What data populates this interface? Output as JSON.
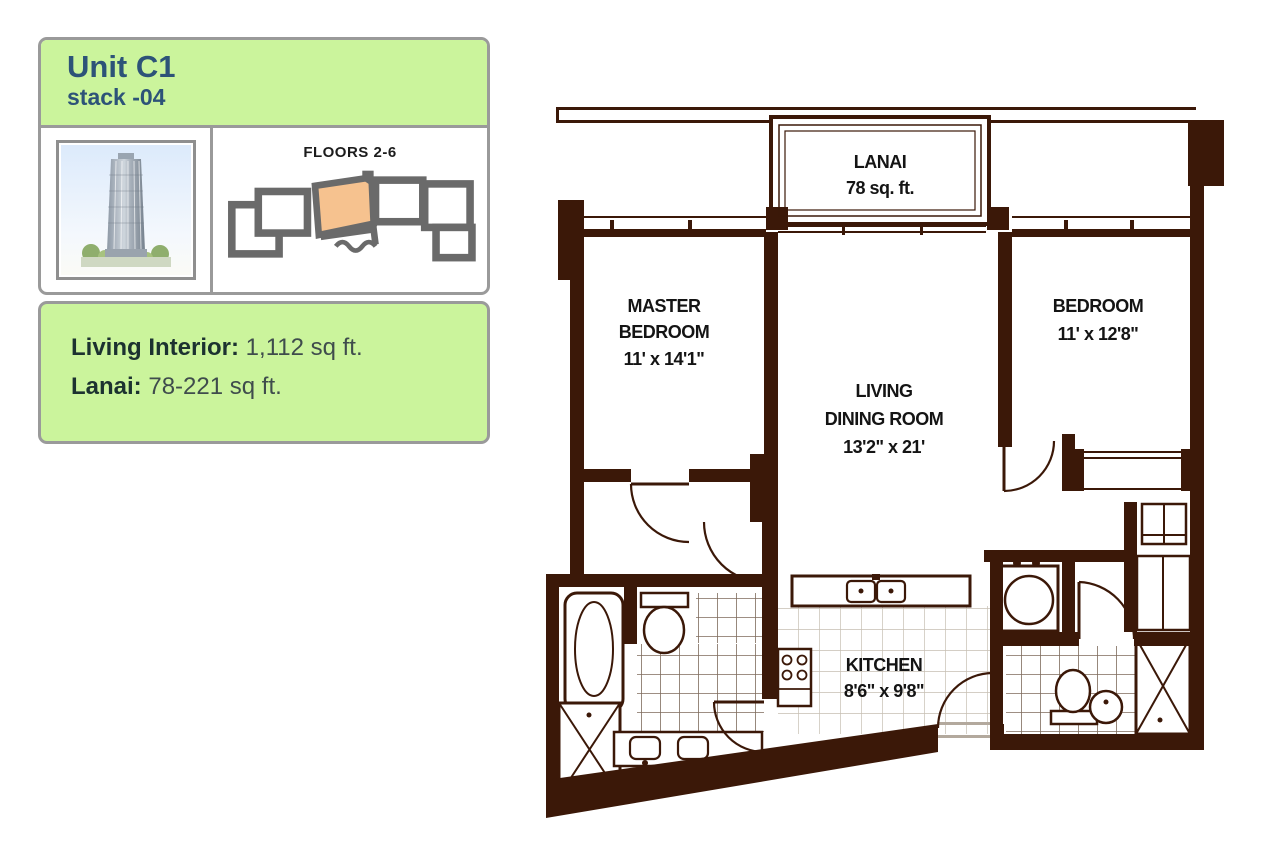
{
  "panel": {
    "title": "Unit C1",
    "subtitle": "stack -04",
    "floors_label": "FLOORS 2-6",
    "stats": {
      "living_interior_label": "Living Interior:",
      "living_interior_value": "1,112 sq ft.",
      "lanai_label": "Lanai:",
      "lanai_value": "78-221 sq ft."
    }
  },
  "plan": {
    "rooms": {
      "lanai": {
        "name": "LANAI",
        "area": "78 sq. ft."
      },
      "master_bedroom": {
        "line1": "MASTER",
        "line2": "BEDROOM",
        "dims": "11' x 14'1\""
      },
      "living_dining": {
        "line1": "LIVING",
        "line2": "DINING ROOM",
        "dims": "13'2\" x 21'"
      },
      "bedroom": {
        "name": "BEDROOM",
        "dims": "11' x 12'8\""
      },
      "kitchen": {
        "name": "KITCHEN",
        "dims": "8'6\" x 9'8\""
      }
    }
  },
  "colors": {
    "card_green": "#cbf49c",
    "card_border_gray": "#9a9a9a",
    "title_blue": "#2d5378",
    "wall_brown": "#3b1808",
    "highlight_orange": "#f6c28f",
    "plate_gray": "#6a6a6a"
  }
}
